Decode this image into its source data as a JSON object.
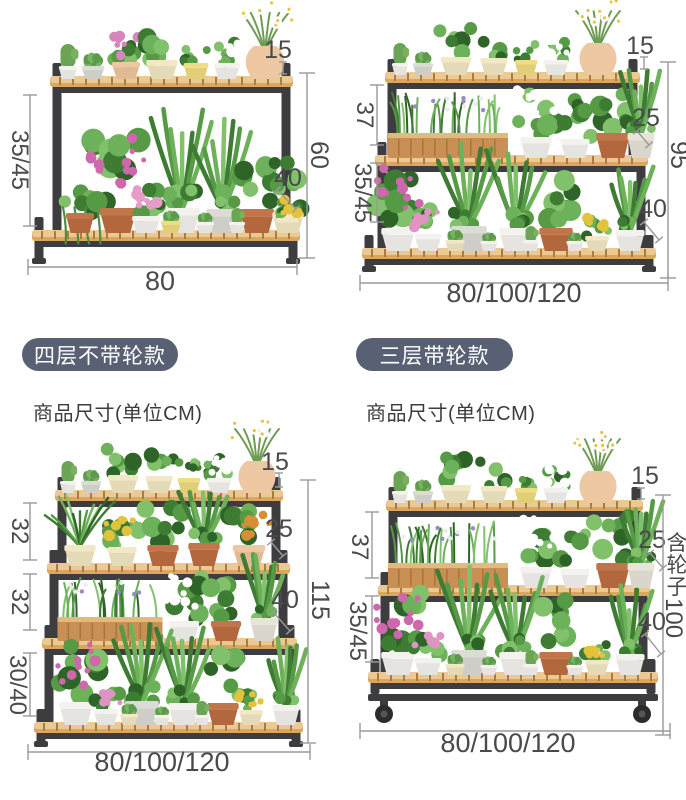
{
  "colors": {
    "background": "#ffffff",
    "badge_bg": "#576173",
    "badge_text": "#ffffff",
    "caption_text": "#3c3c3c",
    "dim_text": "#4a4a4a",
    "dim_line": "#9a9a9a",
    "frame": "#3d3d40",
    "wood": "#e5bd82"
  },
  "sections": [
    {
      "id": "two-tier",
      "dims": {
        "pot_height": "15",
        "gaps": [
          "35/45"
        ],
        "step": null,
        "total_height": "60",
        "depth": "40",
        "width": "80"
      }
    },
    {
      "id": "three-tier",
      "dims": {
        "pot_height": "15",
        "gaps": [
          "37",
          "35/45"
        ],
        "step": "25",
        "total_height": "95",
        "depth": "40",
        "width": "80/100/120"
      }
    },
    {
      "id": "four-tier",
      "badge": "四层不带轮款",
      "caption": "商品尺寸(单位CM)",
      "dims": {
        "pot_height": "15",
        "gaps": [
          "32",
          "32",
          "30/40"
        ],
        "step": "25",
        "total_height": "115",
        "depth": "40",
        "width": "80/100/120"
      }
    },
    {
      "id": "three-tier-wheels",
      "badge": "三层带轮款",
      "caption": "商品尺寸(单位CM)",
      "dims": {
        "pot_height": "15",
        "gaps": [
          "37",
          "35/45"
        ],
        "step": "25",
        "total_height": "含轮子100",
        "depth": "40",
        "width": "80/100/120"
      }
    }
  ]
}
